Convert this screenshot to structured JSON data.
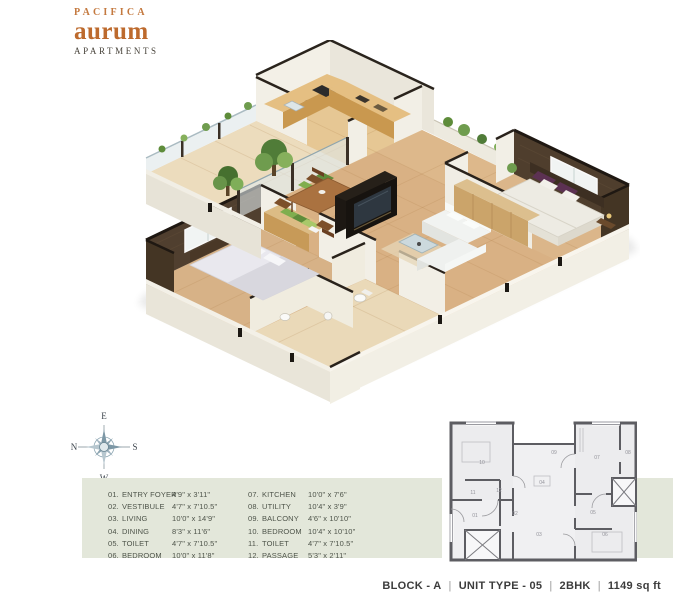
{
  "brand": {
    "name_top": "PACIFICA",
    "name_main": "aurum",
    "name_sub": "APARTMENTS"
  },
  "compass": {
    "top": "E",
    "left": "N",
    "right": "S",
    "bottom": "W"
  },
  "legend": {
    "rows": [
      {
        "num": "01.",
        "name": "ENTRY FOYER",
        "size": "4'9\" x 3'11\""
      },
      {
        "num": "02.",
        "name": "VESTIBULE",
        "size": "4'7\" x 7'10.5\""
      },
      {
        "num": "03.",
        "name": "LIVING",
        "size": "10'0\" x 14'9\""
      },
      {
        "num": "04.",
        "name": "DINING",
        "size": "8'3\" x 11'6\""
      },
      {
        "num": "05.",
        "name": "TOILET",
        "size": "4'7\" x 7'10.5\""
      },
      {
        "num": "06.",
        "name": "BEDROOM",
        "size": "10'0\" x 11'8\""
      },
      {
        "num": "07.",
        "name": "KITCHEN",
        "size": "10'0\" x 7'6\""
      },
      {
        "num": "08.",
        "name": "UTILITY",
        "size": "10'4\" x 3'9\""
      },
      {
        "num": "09.",
        "name": "BALCONY",
        "size": "4'6\" x 10'10\""
      },
      {
        "num": "10.",
        "name": "BEDROOM",
        "size": "10'4\" x 10'10\""
      },
      {
        "num": "11.",
        "name": "TOILET",
        "size": "4'7\" x 7'10.5\""
      },
      {
        "num": "12.",
        "name": "PASSAGE",
        "size": "5'3\" x 2'11\""
      }
    ]
  },
  "mini_plan": {
    "labels": [
      "10",
      "11",
      "12",
      "04",
      "09",
      "07",
      "08",
      "05",
      "06",
      "03",
      "02",
      "01"
    ]
  },
  "footer": {
    "block": "BLOCK - A",
    "separator": "|",
    "unit": "UNIT TYPE - 05",
    "bhk": "2BHK",
    "area": "1149 sq ft"
  },
  "colors": {
    "accent_orange": "#bd6a2d",
    "band_green": "#e3e7da",
    "wall_dark_brown": "#4e3d2d",
    "floor_tan": "#d9b184"
  }
}
